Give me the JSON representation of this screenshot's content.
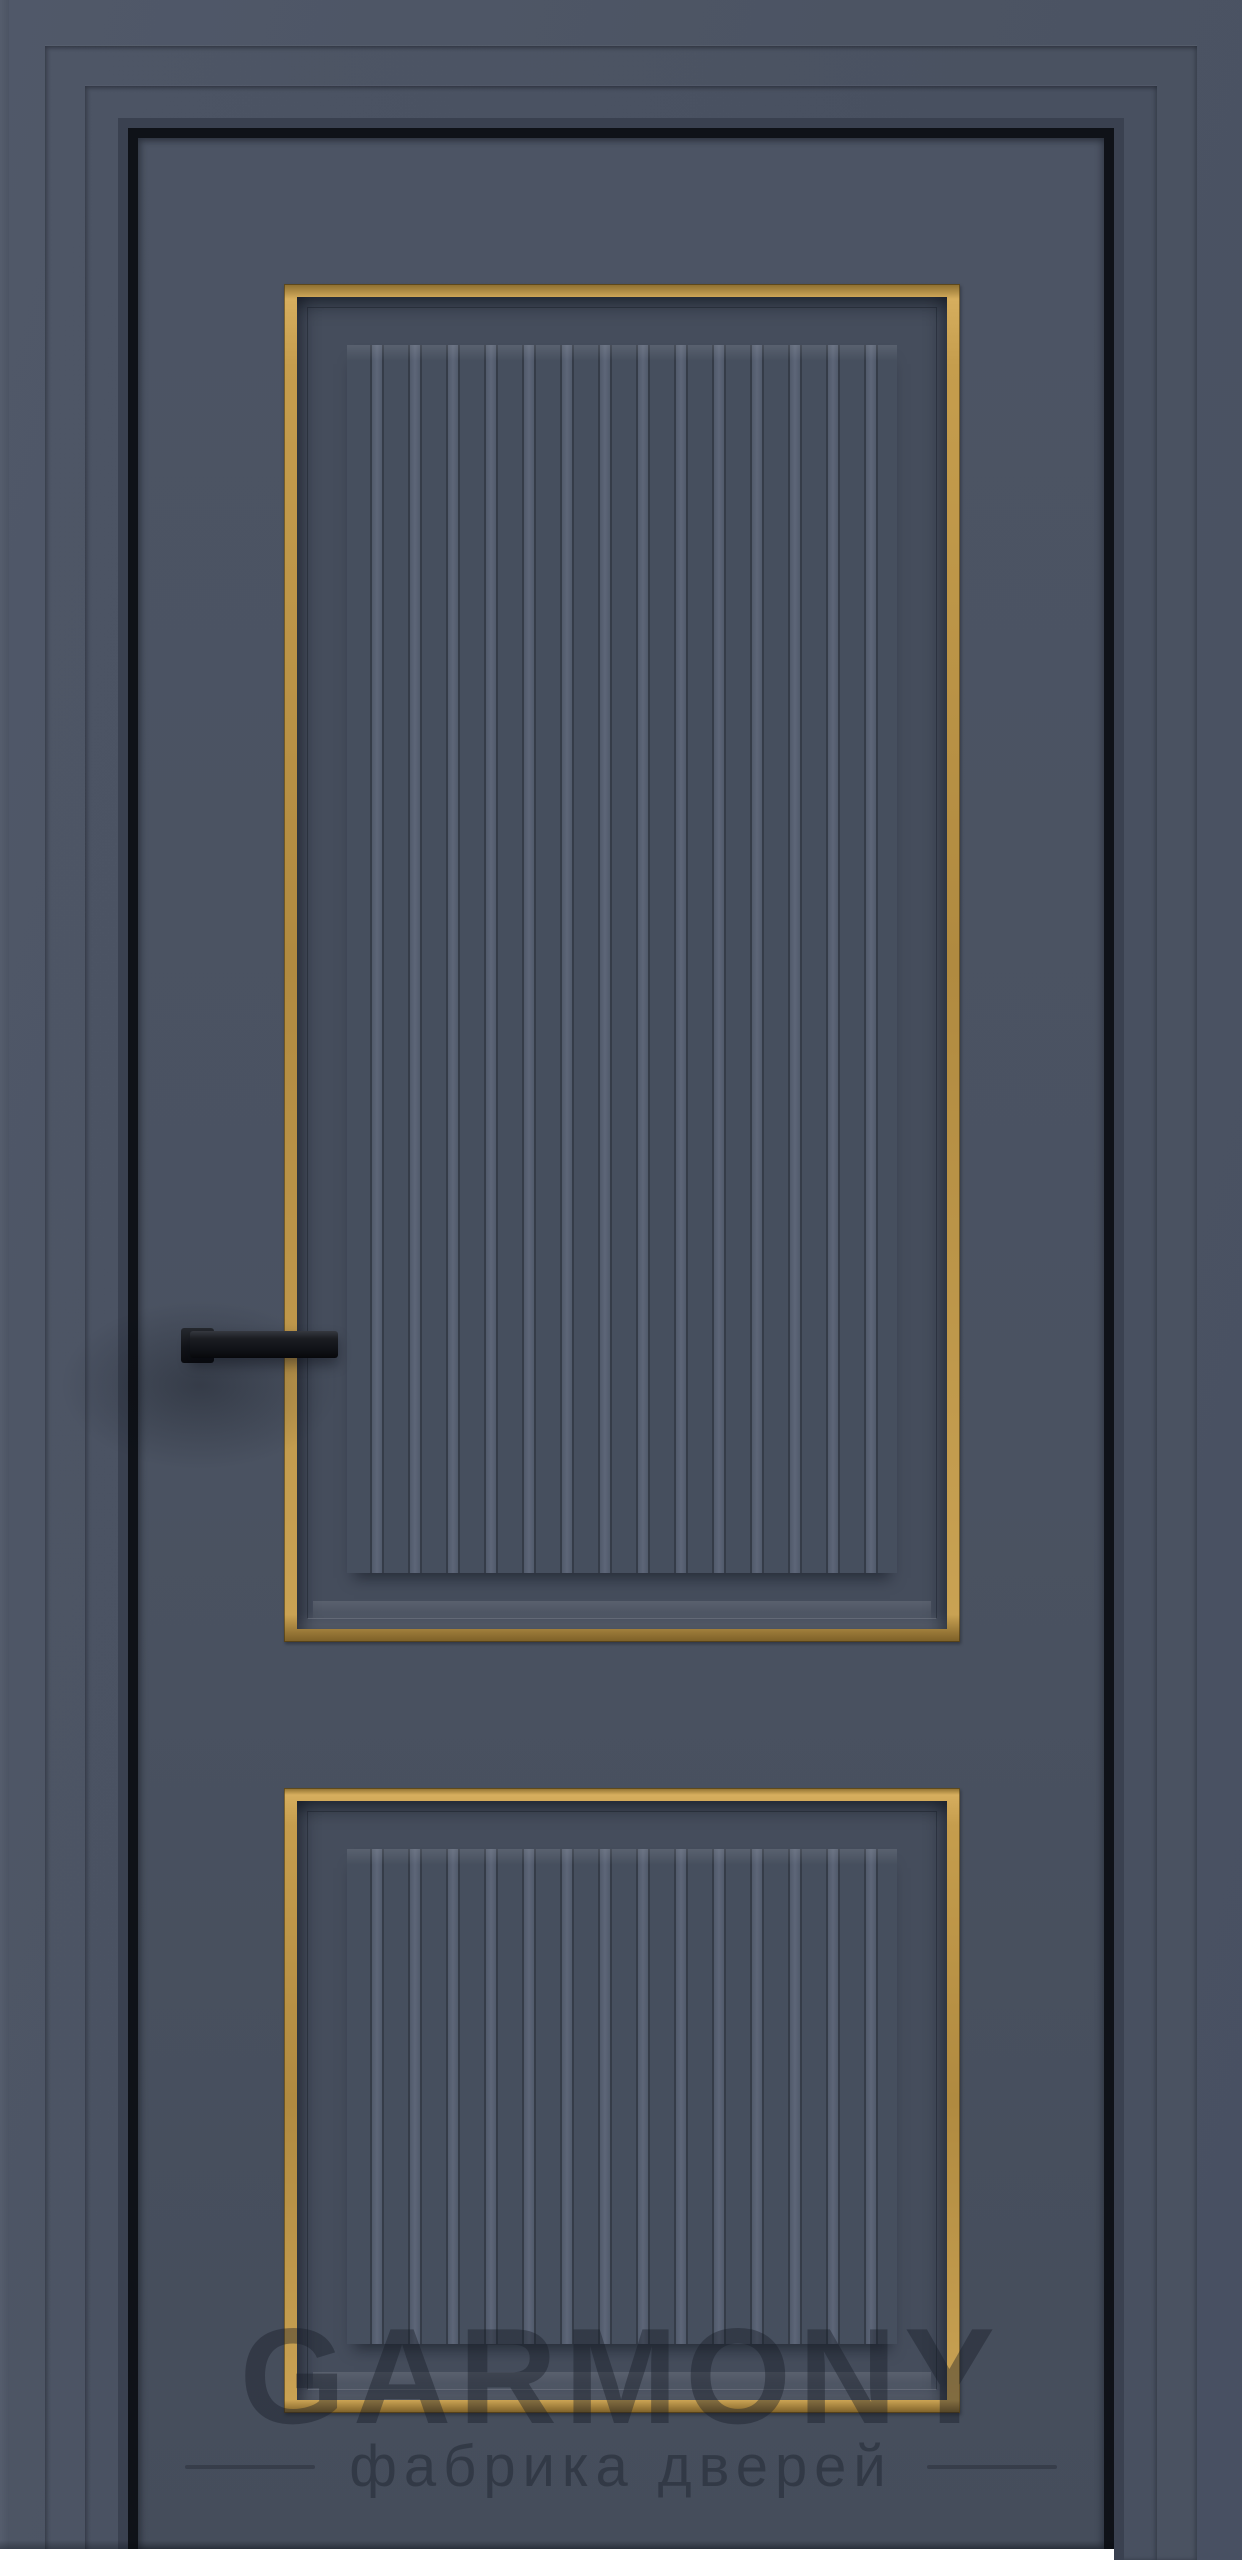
{
  "image": {
    "description": "Dark graphite-blue interior door in a matching casing: two recessed vertical panels with brass-gold trim frames and vertical fluting, a black rectangular lever handle on the left stile, white floor strip at the bottom"
  },
  "watermark": {
    "brand": "GARMONY",
    "tagline": "фабрика дверей"
  },
  "colors": {
    "door_face": "#4a5261",
    "frame_casing": "#4c5463",
    "gold_trim": "#c7a052",
    "panel_recess": "#454d5c",
    "flute_highlight": "#5d6678",
    "flute_shadow": "#353c48",
    "reveal_gap": "#0f1218",
    "handle": "#15171c",
    "floor": "#ffffff"
  }
}
